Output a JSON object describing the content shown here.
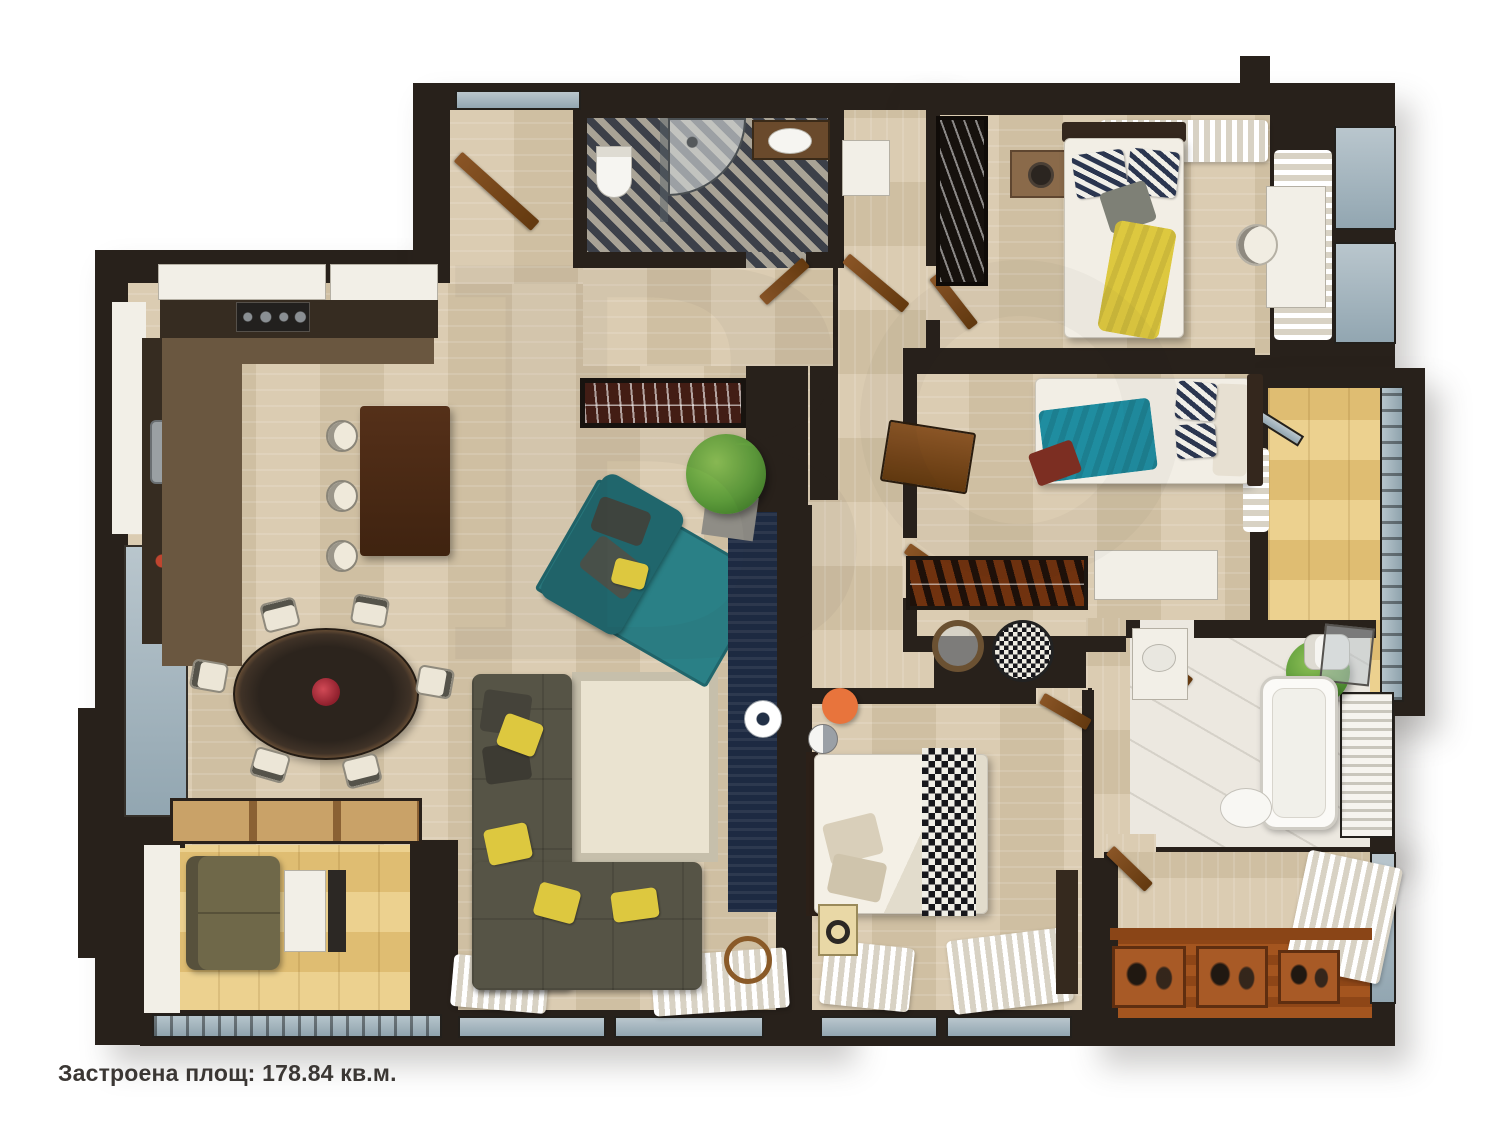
{
  "caption": {
    "text": "Застроена площ: 178.84 кв.м."
  },
  "area": {
    "label": "Застроена площ",
    "value": "178.84",
    "unit": "кв.м."
  },
  "watermark": {
    "glyph": "B"
  },
  "palette": {
    "wall": "#28211b",
    "wood1": "#dbccb2",
    "wood2": "#cfbfa2",
    "kitchenfloor": "#6a5740",
    "counterdark": "#362c21",
    "gold1": "#ecd18f",
    "gold2": "#dfbd72",
    "marble": "#ece8e0",
    "herring_dark": "#3c4049",
    "herring_light": "#a9a396",
    "deck1": "#a4551f",
    "deck2": "#8e4617",
    "sofa": "#565446",
    "rug": "#eae3d0",
    "rug_border": "#c6bfab",
    "teal": "#2a8086",
    "teal_dark": "#20666c",
    "navy": "#1d2a42",
    "yellow": "#ddc83f",
    "orange": "#e8743c",
    "white_furniture": "#f2efe7",
    "glass1": "#b9c6cd",
    "glass2": "#92a6b1",
    "curtain_light": "#ffffff",
    "curtain_shadow": "#d8d2c4",
    "text": "#3b3734"
  }
}
